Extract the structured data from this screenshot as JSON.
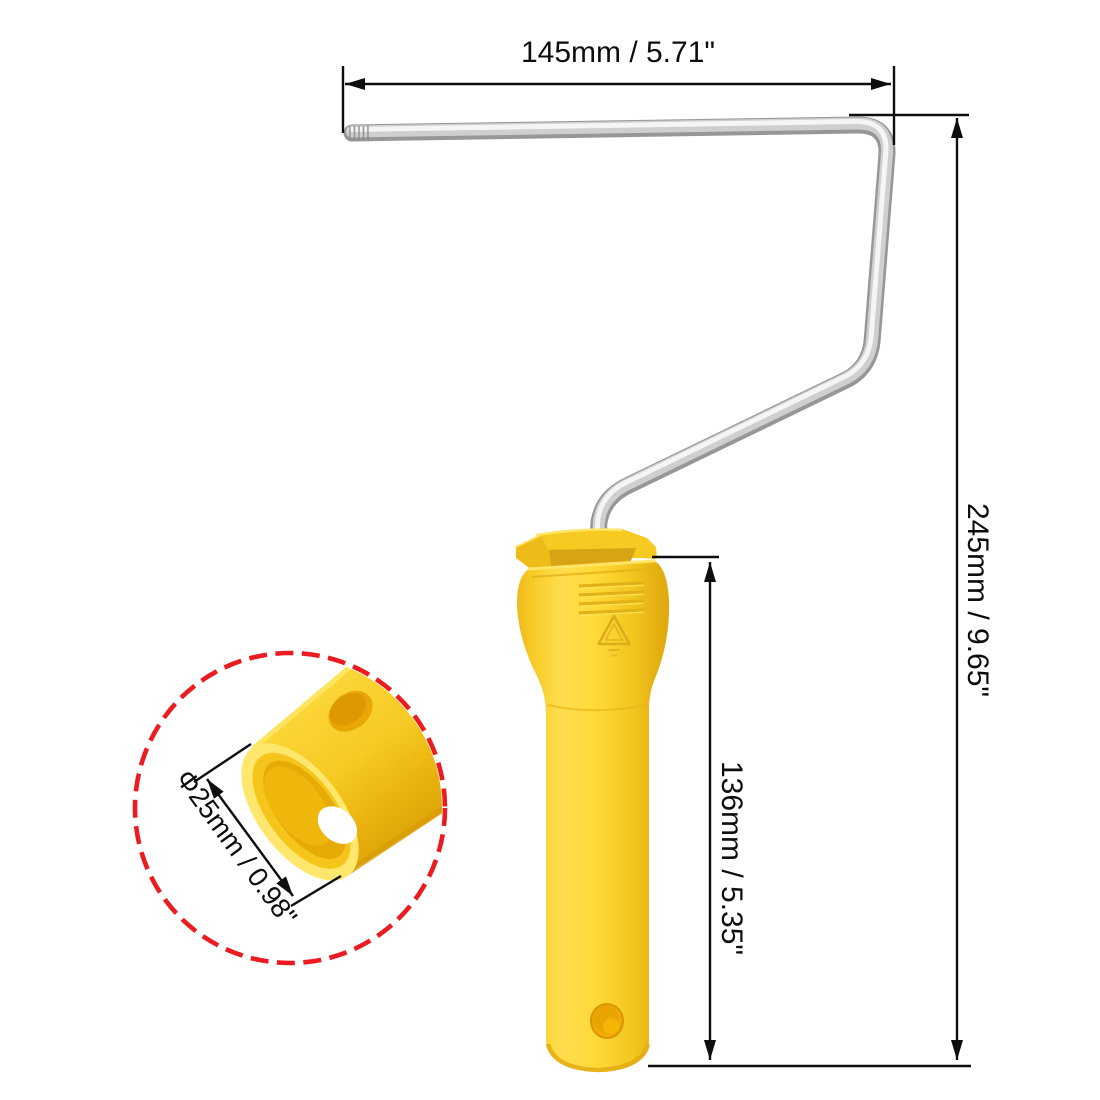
{
  "figure": {
    "type": "product-dimension-diagram",
    "background": "#ffffff"
  },
  "annotations": {
    "width": "145mm / 5.71\"",
    "height": "245mm / 9.65\"",
    "handle_length": "136mm / 5.35\"",
    "inner_diameter": "Φ25mm / 0.98\""
  },
  "colors": {
    "handle_yellow": "#FFD935",
    "handle_highlight": "#FFE65C",
    "handle_shadow": "#E0A90E",
    "rod_silver": "#CDCDCD",
    "callout_red": "#EB1B22",
    "dimension_black": "#0E0E0E"
  }
}
